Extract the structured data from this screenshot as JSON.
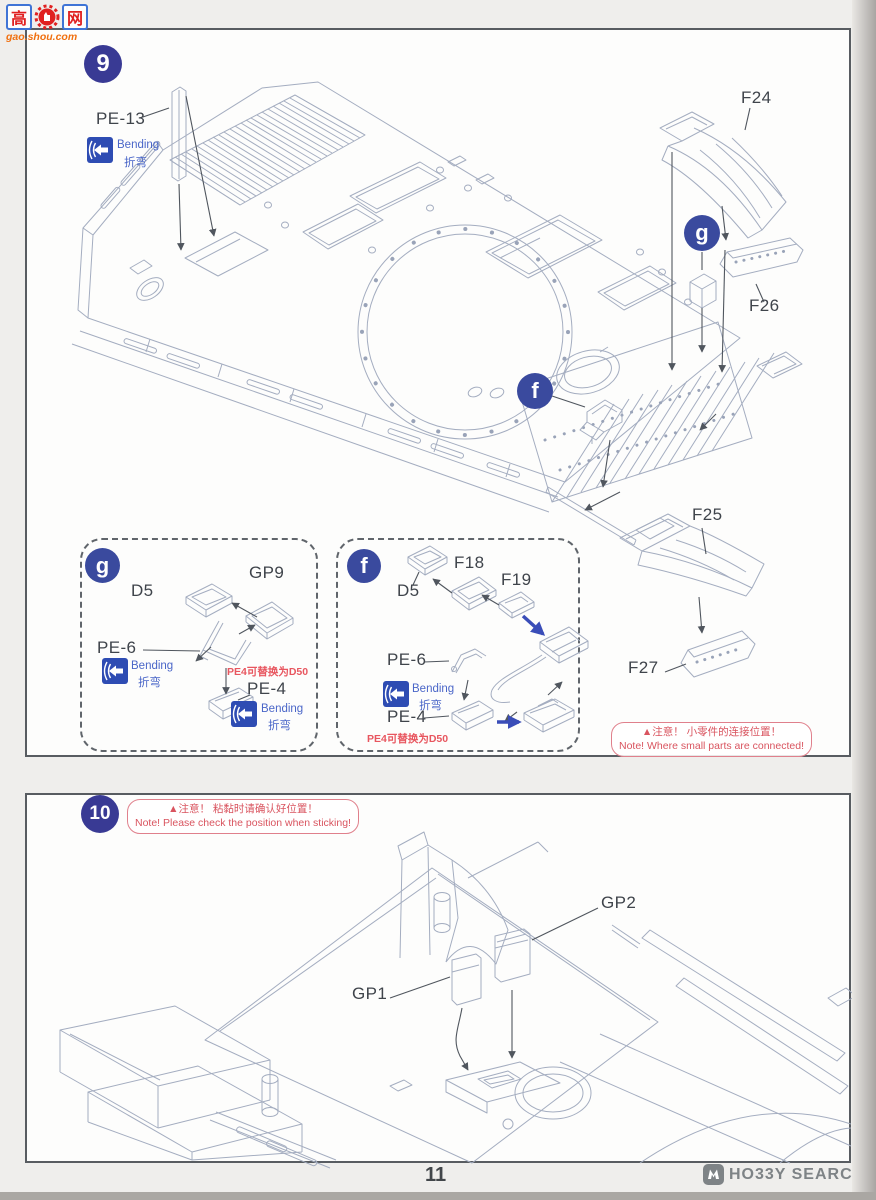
{
  "watermark": {
    "char1": "高",
    "char2": "网",
    "domain": "gao.shou.com"
  },
  "panel9": {
    "step_number": "9",
    "pe13_label": "PE-13",
    "bending_en": "Bending",
    "bending_cn": "折弯",
    "badge_g": "g",
    "badge_f": "f",
    "f24_label": "F24",
    "f26_label": "F26",
    "f25_label": "F25",
    "f27_label": "F27",
    "inset_g": {
      "badge": "g",
      "d5": "D5",
      "gp9": "GP9",
      "pe6": "PE-6",
      "pe4": "PE-4",
      "replace_note": "PE4可替换为D50"
    },
    "inset_f": {
      "badge": "f",
      "d5": "D5",
      "f18": "F18",
      "f19": "F19",
      "pe6": "PE-6",
      "pe4": "PE-4",
      "replace_note": "PE4可替换为D50"
    },
    "note": {
      "cn": "▲注意！ 小零件的连接位置！",
      "en": "Note! Where small parts are connected!"
    }
  },
  "panel10": {
    "step_number": "10",
    "note": {
      "cn": "▲注意！ 粘黏时请确认好位置！",
      "en": "Note! Please check the position when sticking!"
    },
    "gp1_label": "GP1",
    "gp2_label": "GP2"
  },
  "footer": {
    "page_number": "11",
    "brand": "HO33Y SEARCH"
  },
  "colors": {
    "step_badge": "#393a94",
    "letter_badge": "#3a4a9e",
    "bending_blue": "#2e4cb3",
    "note_red": "#d9545f",
    "replace_red": "#e8565f",
    "watermark_orange": "#f07010",
    "line_art": "#a4adc0",
    "leader_dark": "#50565e",
    "blue_arrow": "#3a4db8"
  }
}
